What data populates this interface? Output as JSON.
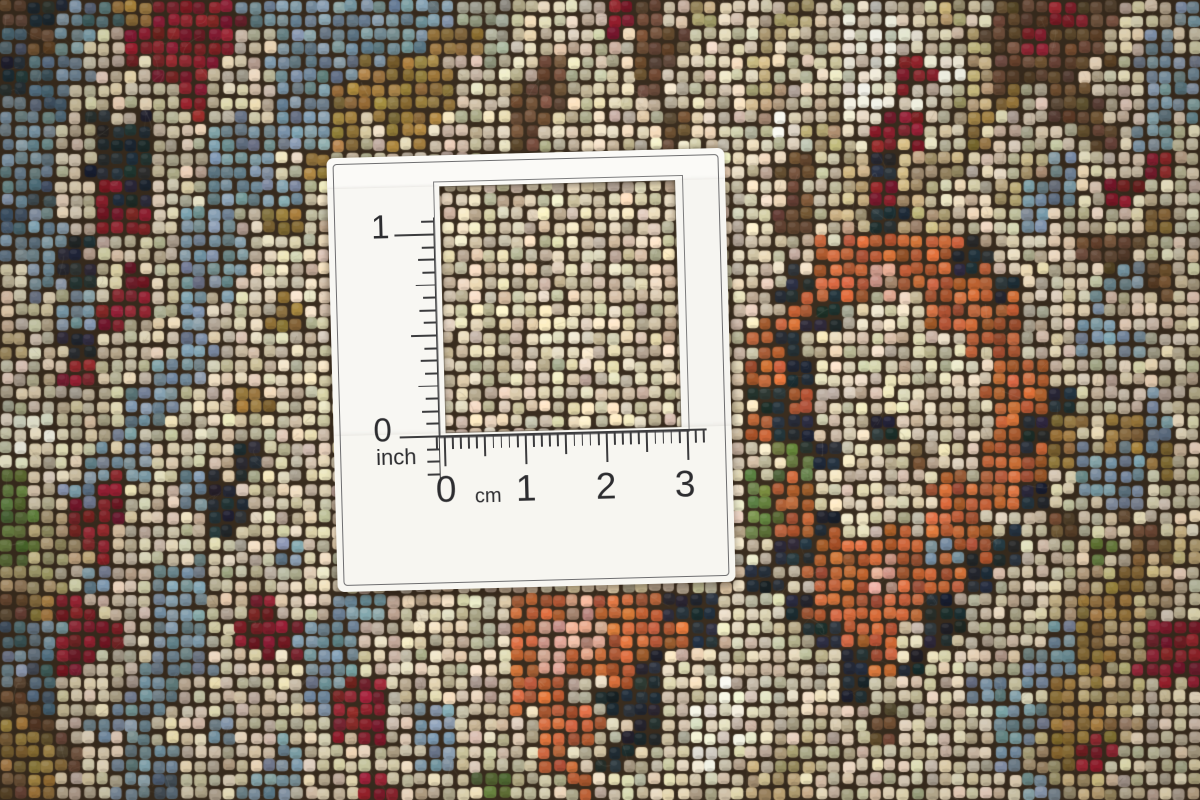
{
  "scene": {
    "description": "Macro photograph of a hand-knotted oriental wool rug in cream, slate blue, rust orange, maroon, olive-gold and brown, with a white knot-density measuring card lying on it. The card has a square cutout window, a vertical inch scale on the left and a horizontal centimetre scale along the bottom of the window."
  },
  "card": {
    "background_color": "#f8f6f2",
    "line_color": "#3c3c3e",
    "vertical_ruler": {
      "tick_labels": [
        "1",
        "0"
      ],
      "unit_label": "inch",
      "divisions_per_unit": 16
    },
    "horizontal_ruler": {
      "tick_labels": [
        "0",
        "1",
        "2",
        "3"
      ],
      "unit_label": "cm",
      "divisions_per_unit": 10
    }
  },
  "rug": {
    "backing_color": "#3a2d1f",
    "knot_size_px": 13.8,
    "pattern_cell_px": 30,
    "palette": {
      "c": "#d8cbae",
      "i": "#eee7d1",
      "k": "#bfab7e",
      "b": "#7d96a4",
      "B": "#516b79",
      "n": "#262f37",
      "r": "#8e2430",
      "o": "#c4663a",
      "g": "#9b7b40",
      "w": "#6f5139",
      "G": "#63793d",
      "p": "#d4a28b",
      "m": "#a4a58f"
    },
    "pattern_rows": [
      "wnbBgrrrbbbbbbbmmcccrwckcckciickcwwrwccb",
      "Bwbcrrrrcbbbbbggmccccwwcckcciiickwrwwcbc",
      "nBbccrrccbbbgggcccwccwccckcciirikwwwccbb",
      "bBccccrccbbggggccwwcccccckcciiickgcwwcbb",
      "bbcnnccbbbbgcgcccwccccwcccikcrrcgcccwcbc",
      "bbcnnccbbcgcccccccccccccccwcknkkcckbccrc",
      "bBcrnccbbbccccccccccccccccwckrkcckbbcrcc",
      "Bbcrrcbbcgccccccccccccccccwcknkkccbcccgc",
      "bbncccbbcccccccccccccccccccoooooncccwwcc",
      "cbncrcbbccccccccccccccccccnoopoooncccbwc",
      "ccbrrcbccgcccccccccccccccconcccoooccbccc",
      "kcncccbcccccccccccccccccconcccccooccbbcc",
      "ccrccbbcccccccccccccccccconccccccooccccc",
      "ccccbbccgccccccccccccccccnoccccccoonccbc",
      "iiccbcccccccccccccccccccconccncccongcgbc",
      "iccbbcccncccccccccccccccccGnccwccoogbbgcb",
      "GcbrccbncccccccccccccccccGoccccoooncbbcc",
      "GkrrcccncccccccccccccccccGoncccooccwcwcc",
      "GkkrcccccbccccccccccccccccnoooobonccGcwkc",
      "kkcbcbbccccccccccccccccccn oopoonccckgkc",
      "wgrccbbcrccbbccccoopoonnccnoooonccckggkc",
      "Bbrrcbbcrrbbcccccoppoooncccnoo ncccbgkrrk",
      "bBrccbbcccbbcccccopoonccccc noncccbbgkrrc",
      "wBccbbccccbrrccccoocnncciiccncccbbcgkkcc",
      "gwcbbccbcccrrcbcccoocnciiccccwcccbbggkcc",
      "ggwcbbcccbccccbcccocnccicckccccccbkgrccc",
      "wgccbBccbbccrcccGccoccccckkcccccccbkkccc"
    ]
  }
}
